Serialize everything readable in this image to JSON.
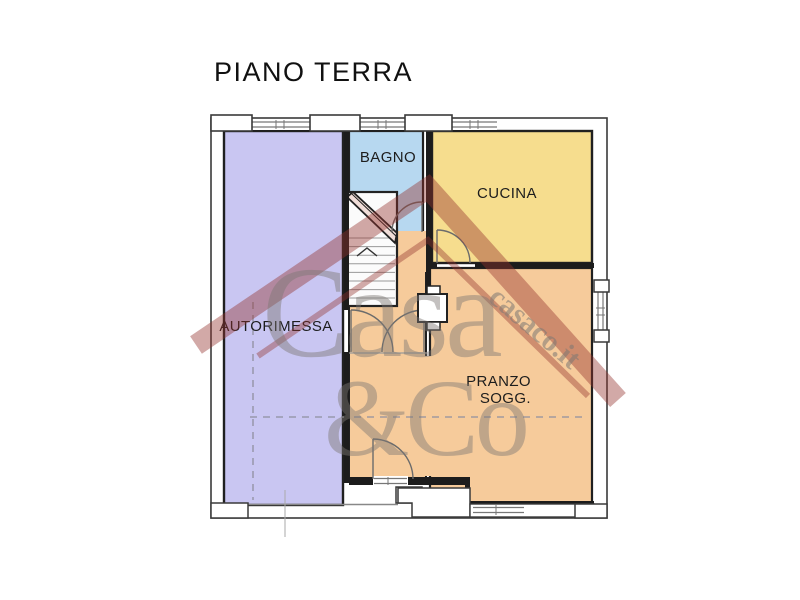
{
  "title": "PIANO TERRA",
  "rooms": {
    "autorimessa": {
      "label": "AUTORIMESSA",
      "color": "#c9c6f2"
    },
    "bagno": {
      "label": "BAGNO",
      "color": "#b7d8f0"
    },
    "cucina": {
      "label": "CUCINA",
      "color": "#f6dd8e"
    },
    "pranzo": {
      "label_line1": "PRANZO",
      "label_line2": "SOGG.",
      "color": "#f6cb9b"
    }
  },
  "watermark": {
    "brand_line1": "Casa",
    "brand_line2": "&Co",
    "site": "casaco.it",
    "roof_color": "#93312e",
    "text_color": "#7d7874"
  },
  "colors": {
    "wall": "#1c1c1c",
    "outline": "#3a3a3a",
    "stair_fill": "#fbfbfb"
  }
}
